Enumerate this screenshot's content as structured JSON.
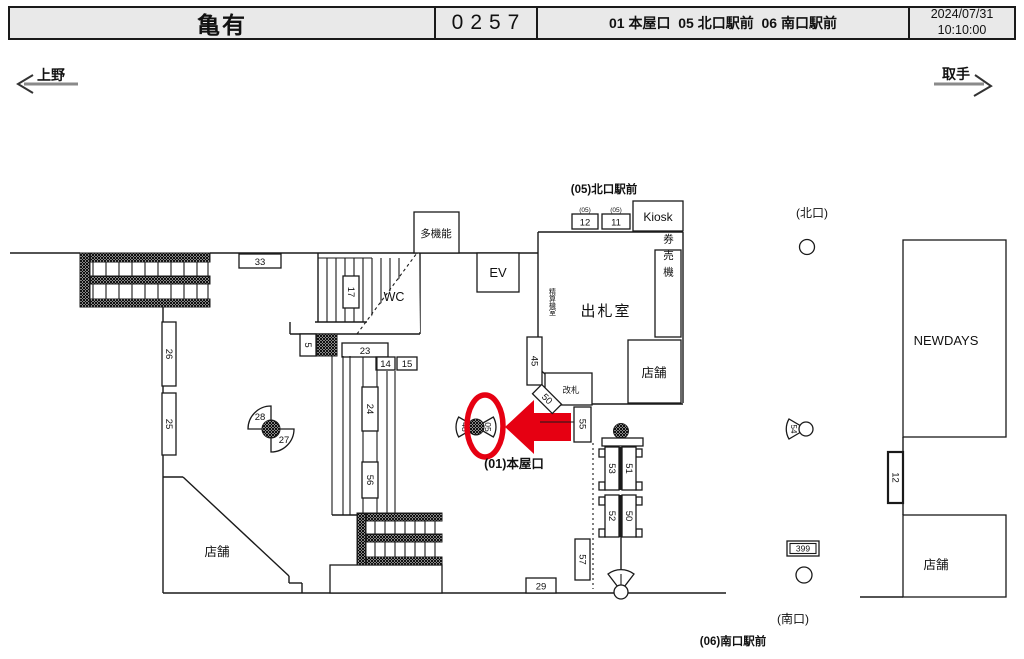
{
  "header": {
    "station": "亀有",
    "code": "0257",
    "camera_list": "01 本屋口  05 北口駅前  06 南口駅前",
    "date": "2024/07/31",
    "time": "10:10:00"
  },
  "nav": {
    "left_station": "上野",
    "right_station": "取手"
  },
  "map": {
    "labels": {
      "north_plaza": "(05)北口駅前",
      "north_exit": "(北口)",
      "south_exit": "(南口)",
      "main_entrance": "(01)本屋口",
      "south_plaza": "(06)南口駅前",
      "multi_function": "多機能",
      "elevator": "EV",
      "toilet": "WC",
      "ticket_office": "出札室",
      "fare_adjust_room": "精算機室",
      "ticket_machine": "券売機",
      "kiosk": "Kiosk",
      "gate": "改札",
      "shop_left": "店舗",
      "shop_office": "店舗",
      "shop_right": "店舗",
      "newdays": "NEWDAYS",
      "tag05_a": "(05)",
      "tag05_b": "(05)"
    },
    "cameras": {
      "c33": "33",
      "c17": "17",
      "c5": "5",
      "c23": "23",
      "c14": "14",
      "c15": "15",
      "c26": "26",
      "c25": "25",
      "c24": "24",
      "c56": "56",
      "c28": "28",
      "c27": "27",
      "c48": "48",
      "c05": "05",
      "c45": "45",
      "c50a": "50",
      "c55": "55",
      "c12n": "12",
      "c11n": "11",
      "c53": "53",
      "c51": "51",
      "c52": "52",
      "c50b": "50",
      "c57": "57",
      "c29": "29",
      "c54": "54",
      "c399": "399",
      "c12e": "12"
    }
  },
  "colors": {
    "accent": "#e60012"
  }
}
